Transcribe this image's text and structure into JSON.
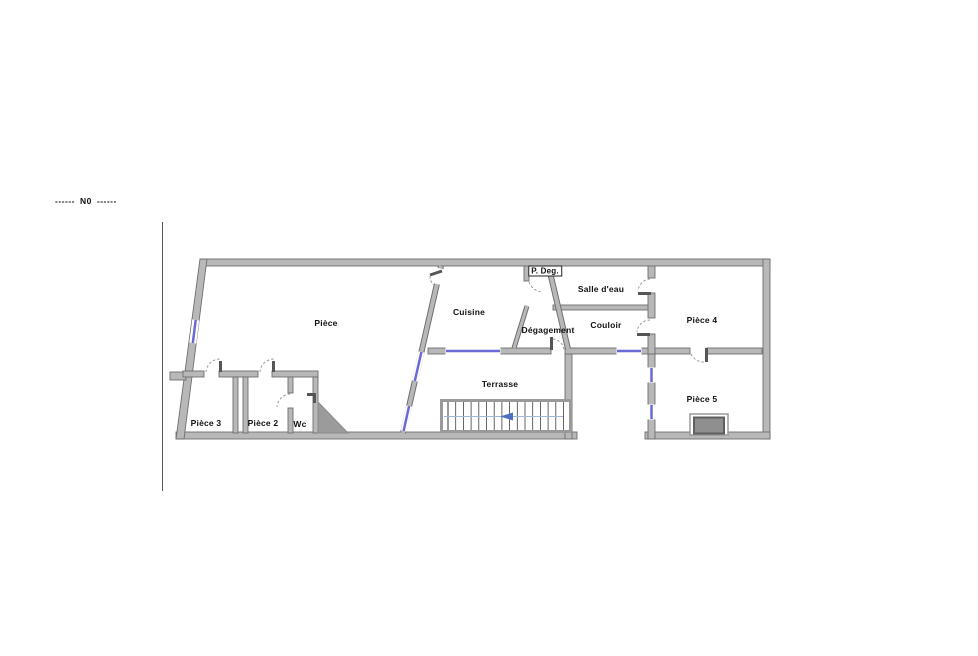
{
  "north_note": {
    "left_dashes": "------",
    "label": "N0",
    "right_dashes": "------"
  },
  "rooms": [
    {
      "id": "piece",
      "name": "Pièce"
    },
    {
      "id": "cuisine",
      "name": "Cuisine"
    },
    {
      "id": "p-deg",
      "name": "P. Deg."
    },
    {
      "id": "salle-deau",
      "name": "Salle d'eau"
    },
    {
      "id": "degagement",
      "name": "Dégagement"
    },
    {
      "id": "couloir",
      "name": "Couloir"
    },
    {
      "id": "piece-4",
      "name": "Pièce 4"
    },
    {
      "id": "terrasse",
      "name": "Terrasse"
    },
    {
      "id": "piece-5",
      "name": "Pièce 5"
    },
    {
      "id": "piece-3",
      "name": "Pièce 3"
    },
    {
      "id": "piece-2",
      "name": "Pièce 2"
    },
    {
      "id": "wc",
      "name": "Wc"
    }
  ],
  "icons": {
    "stair_direction_arrow": "left-pointing-triangle"
  },
  "colors": {
    "floor": "#ffffff",
    "wall_fill": "#b8b8b8",
    "wall_edge": "#6e6e6e",
    "window_blue": "#6a6ad6",
    "door_arc": "#9a9a9a",
    "stair_tread": "#3f3f3f",
    "stair_mid_line": "#9fb7d8",
    "stair_arrow": "#4f6fc0",
    "under_stairs_fill": "#9b9b9b",
    "chimney_fill": "#8f8f8f",
    "note_text": "#111111",
    "reference_line": "#555555"
  }
}
